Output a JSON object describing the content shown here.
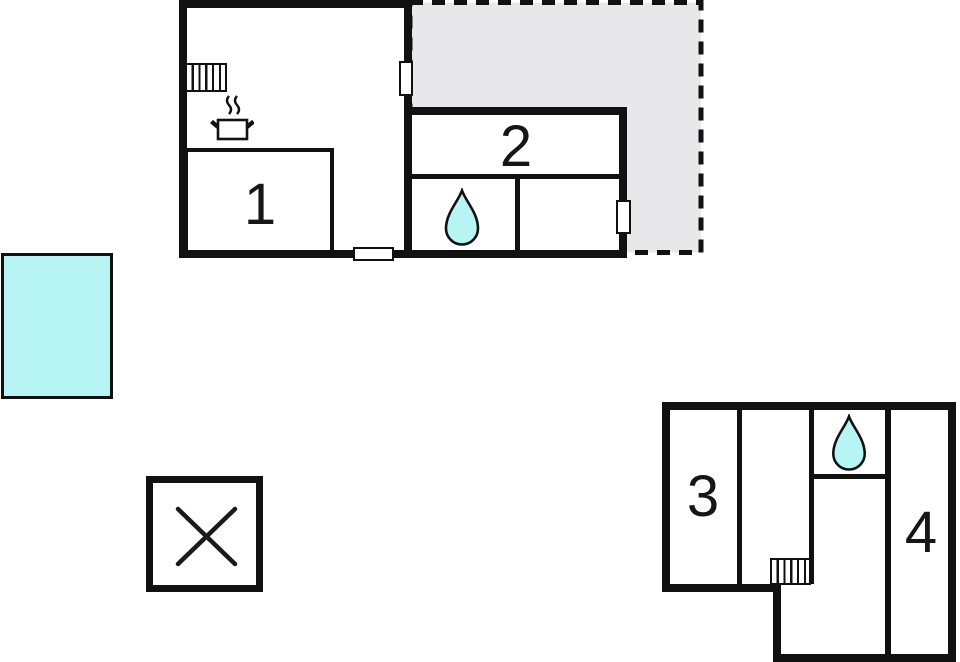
{
  "floorplan": {
    "type": "vacation-home-floor-plan",
    "colors": {
      "wall": "#111111",
      "terrace_fill": "#e8e8ea",
      "water_fill": "#b7f5f5",
      "background": "#ffffff"
    },
    "main_building": {
      "rooms": [
        {
          "id": "room-1",
          "label": "1"
        },
        {
          "id": "room-2",
          "label": "2"
        }
      ],
      "features": [
        "radiator-icon",
        "stove-pot-icon",
        "water-drop-icon"
      ],
      "door_openings": 3
    },
    "terrace": {
      "outline": "dashed",
      "fill": "gray"
    },
    "annex_building": {
      "rooms": [
        {
          "id": "room-3",
          "label": "3"
        },
        {
          "id": "room-4",
          "label": "4"
        }
      ],
      "features": [
        "water-drop-icon",
        "radiator-icon"
      ]
    },
    "pool": {
      "shape": "rectangle",
      "fill": "cyan"
    },
    "shed": {
      "symbol": "X"
    }
  }
}
